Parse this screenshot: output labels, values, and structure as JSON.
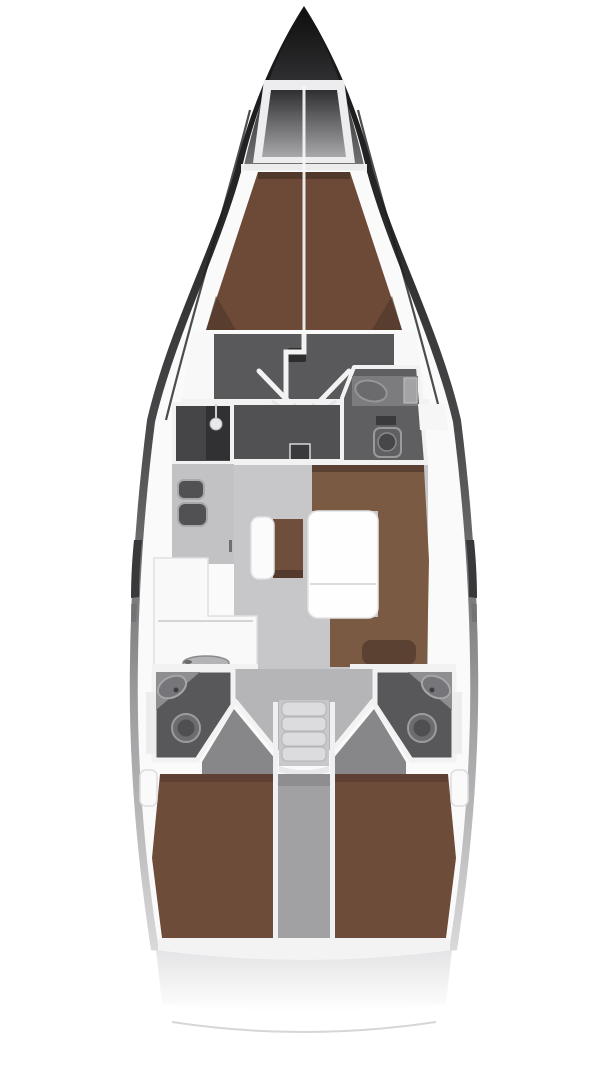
{
  "diagram": {
    "type": "boat-floorplan",
    "view": "top-down interior layout, bow at top, stern at bottom",
    "palette": {
      "bg": "#ffffff",
      "hull-dark": "#141416",
      "hull-mid": "#4a4a4c",
      "deck-white": "#fafafa",
      "wall-white": "#f2f2f3",
      "locker-dark": "#2f2f31",
      "floor-light": "#c7c7c9",
      "floor-mid": "#b5b5b7",
      "floor-dark": "#59595b",
      "corridor-dark": "#515153",
      "room-dark": "#454547",
      "head-gray": "#58585a",
      "head-counter": "#8e8e90",
      "fixture-gray": "#6c6c6f",
      "berth-fore-brown": "#6d4a38",
      "berth-aft-brown": "#6e4c3a",
      "sofa-brown": "#7b5a44",
      "sofa-brown-dark": "#5a4133",
      "counter-white": "#f9f9fa",
      "steps-gray": "#dcdcde",
      "engine-gray": "#a1a1a4",
      "table-white": "#fefefe",
      "transom-line": "#d6d6d8"
    },
    "regions": [
      {
        "id": "anchor-locker",
        "label": "anchor locker at bow"
      },
      {
        "id": "v-berth",
        "label": "forward cabin V-berth"
      },
      {
        "id": "forward-cabin-floor",
        "label": "forward cabin dressing area"
      },
      {
        "id": "wardrobe-shower",
        "label": "port shower wardrobe compartment"
      },
      {
        "id": "forward-head",
        "label": "starboard forward head with sink and toilet"
      },
      {
        "id": "galley",
        "label": "port galley with twin sinks, L-counter and stove"
      },
      {
        "id": "salon",
        "label": "salon with U-sofa, folding table, bench and stool"
      },
      {
        "id": "companionway",
        "label": "companionway steps"
      },
      {
        "id": "port-aft-head",
        "label": "port aft head with sink and toilet"
      },
      {
        "id": "starboard-aft-head",
        "label": "starboard aft head with sink and toilet"
      },
      {
        "id": "port-aft-cabin",
        "label": "port aft cabin double berth"
      },
      {
        "id": "starboard-aft-cabin",
        "label": "starboard aft cabin double berth"
      },
      {
        "id": "engine-compartment",
        "label": "engine compartment between aft cabins"
      },
      {
        "id": "stern",
        "label": "stern deck and transom curve"
      }
    ]
  }
}
